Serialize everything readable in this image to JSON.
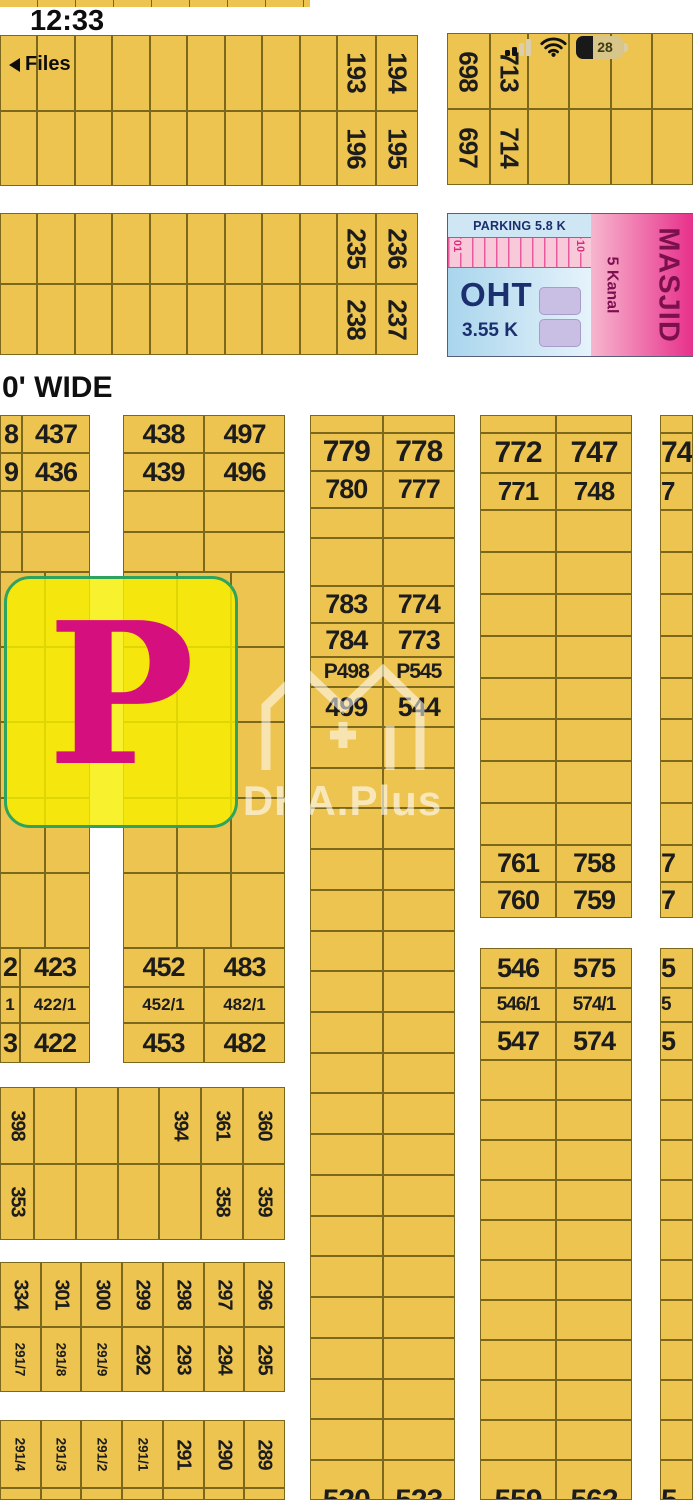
{
  "status_bar": {
    "time": "12:33",
    "back": "Files",
    "battery": "28"
  },
  "road": {
    "label": "0' WIDE"
  },
  "watermark": {
    "text": "DHA.Plus"
  },
  "colors": {
    "plot_fill": "#eec450",
    "grid_line": "#7b681c",
    "number_ink": "#1c1c1c",
    "park_border": "#2ea35e",
    "park_letter": "#d50f7d",
    "masjid_pink": "#e72f8a",
    "parking_blue": "#cfe6f4",
    "oht_navy": "#1b2f6e"
  },
  "park": {
    "label": "P"
  },
  "facility": {
    "parking": "PARKING 5.8 K",
    "stall_start": "01",
    "stall_end": "10",
    "oht": "OHT",
    "oht_area": "3.55 K",
    "masjid": "MASJID",
    "masjid_area": "5 Kanal"
  },
  "top_left_block": {
    "row1": [
      "193",
      "194"
    ],
    "row2": [
      "196",
      "195"
    ]
  },
  "top_right_block": {
    "row1": [
      "698",
      "713"
    ],
    "row2": [
      "697",
      "714"
    ]
  },
  "second_left_block": {
    "row1": [
      "235",
      "236"
    ],
    "row2": [
      "238",
      "237"
    ]
  },
  "west_upper_a": {
    "row1": [
      "8",
      "437"
    ],
    "row2": [
      "9",
      "436"
    ]
  },
  "west_upper_b": {
    "row1": [
      "438",
      "497"
    ],
    "row2": [
      "439",
      "496"
    ]
  },
  "west_lower_a": {
    "row1": [
      "2",
      "423"
    ],
    "row2": [
      "1",
      "422/1"
    ],
    "row3": [
      "3",
      "422"
    ]
  },
  "west_lower_b": {
    "row1": [
      "452",
      "483"
    ],
    "row2": [
      "452/1",
      "482/1"
    ],
    "row3": [
      "453",
      "482"
    ]
  },
  "band_394": {
    "row1": [
      "398",
      "394",
      "361",
      "360"
    ],
    "row2": [
      "353",
      "358",
      "359"
    ]
  },
  "band_296": {
    "row1": [
      "334",
      "301",
      "300",
      "299",
      "298",
      "297",
      "296"
    ],
    "row2": [
      "291/7",
      "291/8",
      "291/9",
      "292",
      "293",
      "294",
      "295"
    ]
  },
  "band_289": {
    "row1": [
      "291/4",
      "291/3",
      "291/2",
      "291/1",
      "291",
      "290",
      "289"
    ]
  },
  "center_block": {
    "r1": [
      "779",
      "778"
    ],
    "r2": [
      "780",
      "777"
    ],
    "r3": [
      "783",
      "774"
    ],
    "r4": [
      "784",
      "773"
    ],
    "r5": [
      "P498",
      "P545"
    ],
    "r6": [
      "499",
      "544"
    ],
    "bottom": [
      "520",
      "523"
    ]
  },
  "east_block_top": {
    "r1": [
      "772",
      "747"
    ],
    "r2": [
      "771",
      "748"
    ],
    "r3": [
      "761",
      "758"
    ],
    "r4": [
      "760",
      "759"
    ]
  },
  "east_block_bottom": {
    "r1": [
      "546",
      "575"
    ],
    "r2": [
      "546/1",
      "574/1"
    ],
    "r3": [
      "547",
      "574"
    ],
    "bottom": [
      "559",
      "562"
    ]
  },
  "edge_block": {
    "top": [
      "74",
      "7"
    ],
    "mid": [
      "7",
      "7"
    ],
    "low": [
      "5",
      "5",
      "5"
    ],
    "bottom": "5"
  }
}
